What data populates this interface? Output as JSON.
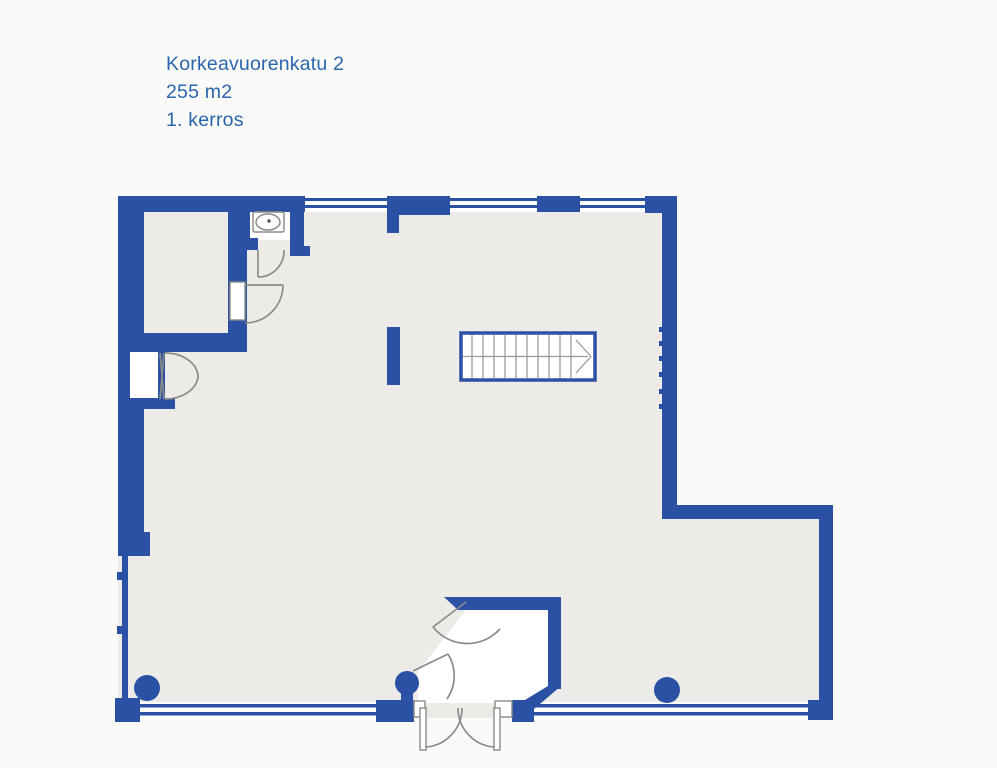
{
  "title": {
    "line1": "Korkeavuorenkatu 2",
    "line2": "255 m2",
    "line3": "1. kerros"
  },
  "colors": {
    "wall_blue": "#2a51a4",
    "title_text": "#2a65ad",
    "floor_fill": "#ecebe7",
    "door_gray": "#8b8b89",
    "stair_gray": "#9a9a98",
    "paper": "#fafaf9",
    "white": "#ffffff"
  }
}
